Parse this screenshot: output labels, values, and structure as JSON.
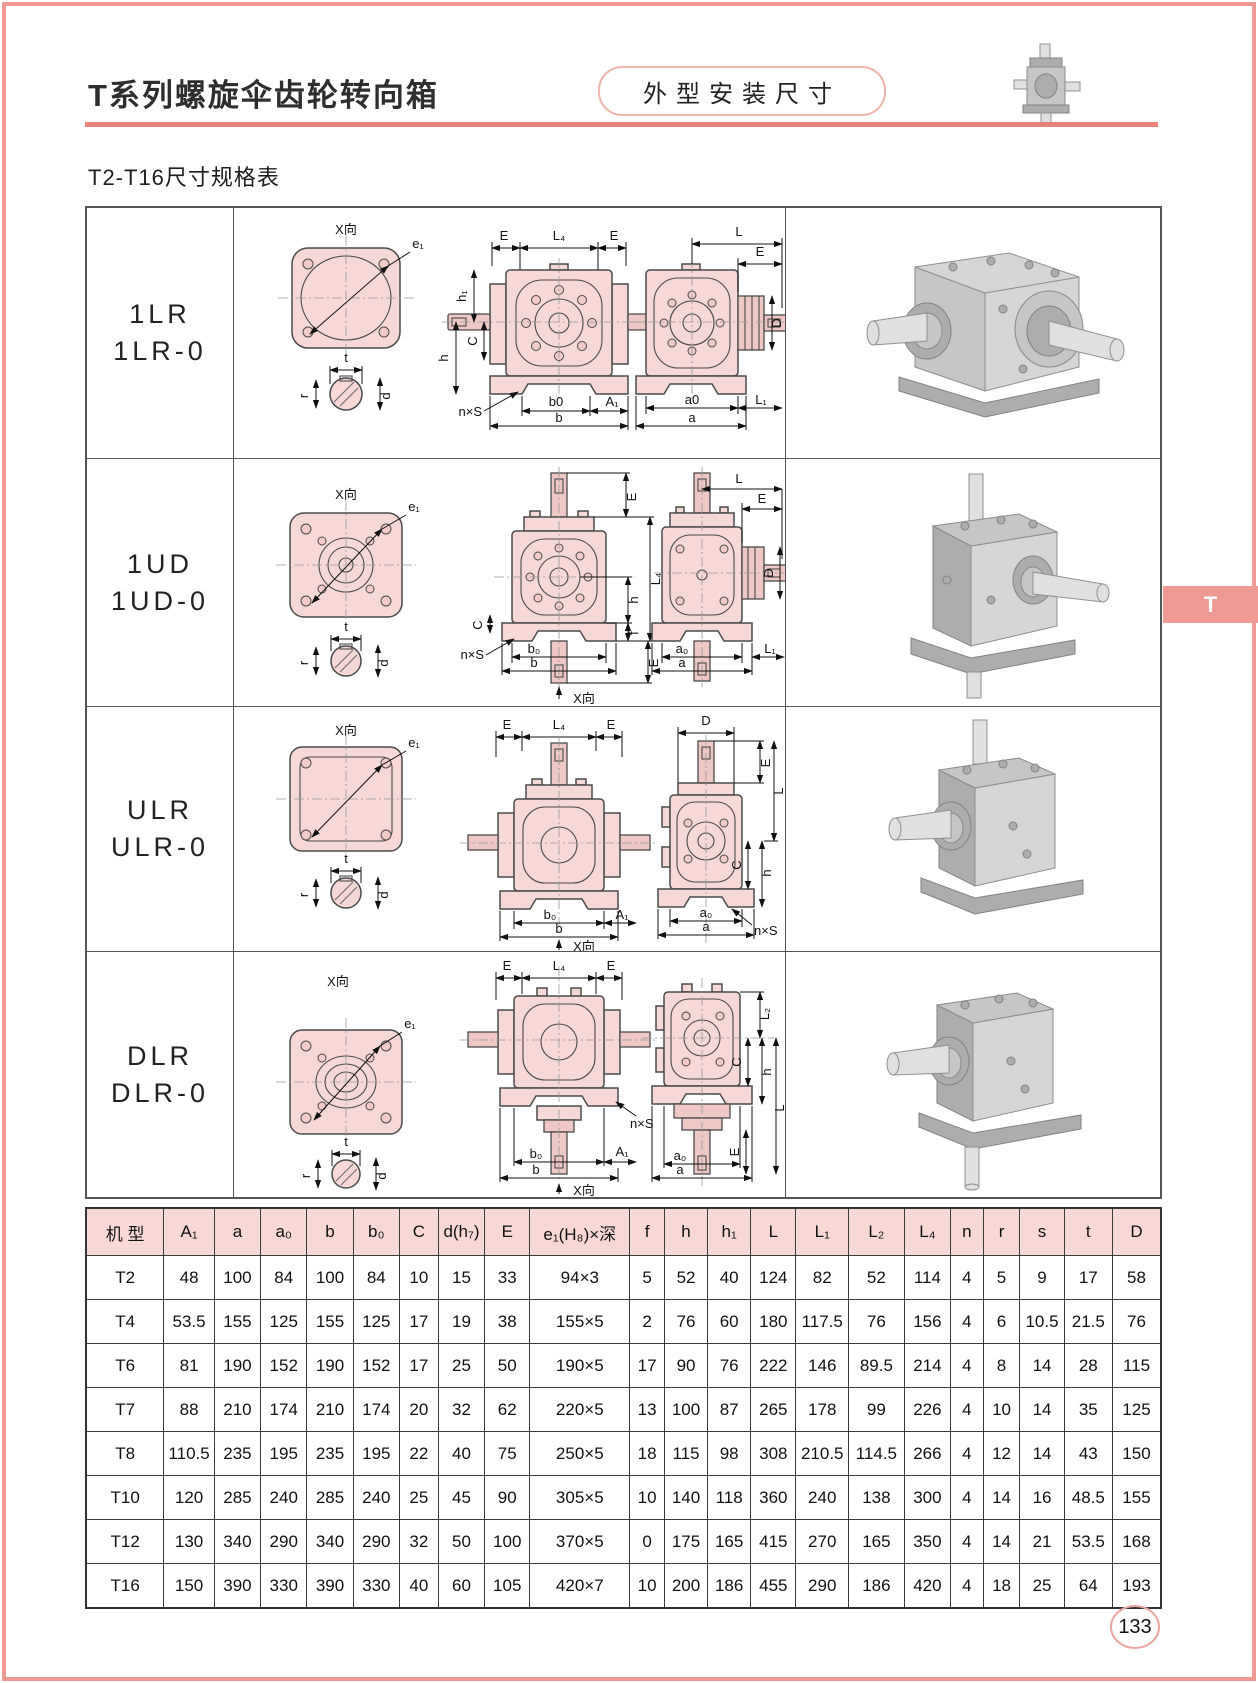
{
  "header": {
    "title": "T系列螺旋伞齿轮转向箱",
    "badge": "外型安装尺寸"
  },
  "section": {
    "label": "T2-T16尺寸规格表"
  },
  "side_tab": {
    "label": "T"
  },
  "page": {
    "number": "133"
  },
  "models": [
    {
      "line1": "1LR",
      "line2": "1LR-0"
    },
    {
      "line1": "1UD",
      "line2": "1UD-0"
    },
    {
      "line1": "ULR",
      "line2": "ULR-0"
    },
    {
      "line1": "DLR",
      "line2": "DLR-0"
    }
  ],
  "dims": {
    "xdir": "X向",
    "e1": "e₁",
    "E": "E",
    "L": "L",
    "L1": "L₁",
    "L2": "L₂",
    "L4": "L₄",
    "D": "D",
    "C": "C",
    "h": "h",
    "h1": "h₁",
    "f": "f",
    "nxs": "n×S",
    "b": "b",
    "b0": "b₀",
    "b0_plain": "b0",
    "a": "a",
    "a0": "a₀",
    "a0_plain": "a0",
    "A1": "A₁",
    "t": "t",
    "r": "r",
    "d": "d"
  },
  "spec_table": {
    "headers": [
      "机 型",
      "A₁",
      "a",
      "a₀",
      "b",
      "b₀",
      "C",
      "d(h₇)",
      "E",
      "e₁(H₈)×深",
      "f",
      "h",
      "h₁",
      "L",
      "L₁",
      "L₂",
      "L₄",
      "n",
      "r",
      "s",
      "t",
      "D"
    ],
    "rows": [
      [
        "T2",
        "48",
        "100",
        "84",
        "100",
        "84",
        "10",
        "15",
        "33",
        "94×3",
        "5",
        "52",
        "40",
        "124",
        "82",
        "52",
        "114",
        "4",
        "5",
        "9",
        "17",
        "58"
      ],
      [
        "T4",
        "53.5",
        "155",
        "125",
        "155",
        "125",
        "17",
        "19",
        "38",
        "155×5",
        "2",
        "76",
        "60",
        "180",
        "117.5",
        "76",
        "156",
        "4",
        "6",
        "10.5",
        "21.5",
        "76"
      ],
      [
        "T6",
        "81",
        "190",
        "152",
        "190",
        "152",
        "17",
        "25",
        "50",
        "190×5",
        "17",
        "90",
        "76",
        "222",
        "146",
        "89.5",
        "214",
        "4",
        "8",
        "14",
        "28",
        "115"
      ],
      [
        "T7",
        "88",
        "210",
        "174",
        "210",
        "174",
        "20",
        "32",
        "62",
        "220×5",
        "13",
        "100",
        "87",
        "265",
        "178",
        "99",
        "226",
        "4",
        "10",
        "14",
        "35",
        "125"
      ],
      [
        "T8",
        "110.5",
        "235",
        "195",
        "235",
        "195",
        "22",
        "40",
        "75",
        "250×5",
        "18",
        "115",
        "98",
        "308",
        "210.5",
        "114.5",
        "266",
        "4",
        "12",
        "14",
        "43",
        "150"
      ],
      [
        "T10",
        "120",
        "285",
        "240",
        "285",
        "240",
        "25",
        "45",
        "90",
        "305×5",
        "10",
        "140",
        "118",
        "360",
        "240",
        "138",
        "300",
        "4",
        "14",
        "16",
        "48.5",
        "155"
      ],
      [
        "T12",
        "130",
        "340",
        "290",
        "340",
        "290",
        "32",
        "50",
        "100",
        "370×5",
        "0",
        "175",
        "165",
        "415",
        "270",
        "165",
        "350",
        "4",
        "14",
        "21",
        "53.5",
        "168"
      ],
      [
        "T16",
        "150",
        "390",
        "330",
        "390",
        "330",
        "40",
        "60",
        "105",
        "420×7",
        "10",
        "200",
        "186",
        "455",
        "290",
        "186",
        "420",
        "4",
        "18",
        "25",
        "64",
        "193"
      ]
    ]
  },
  "colors": {
    "accent": "#ee9a92",
    "rule": "#ec837b",
    "table_header_bg": "#f8d8d5",
    "drawing_fill": "#f6d8d6"
  }
}
